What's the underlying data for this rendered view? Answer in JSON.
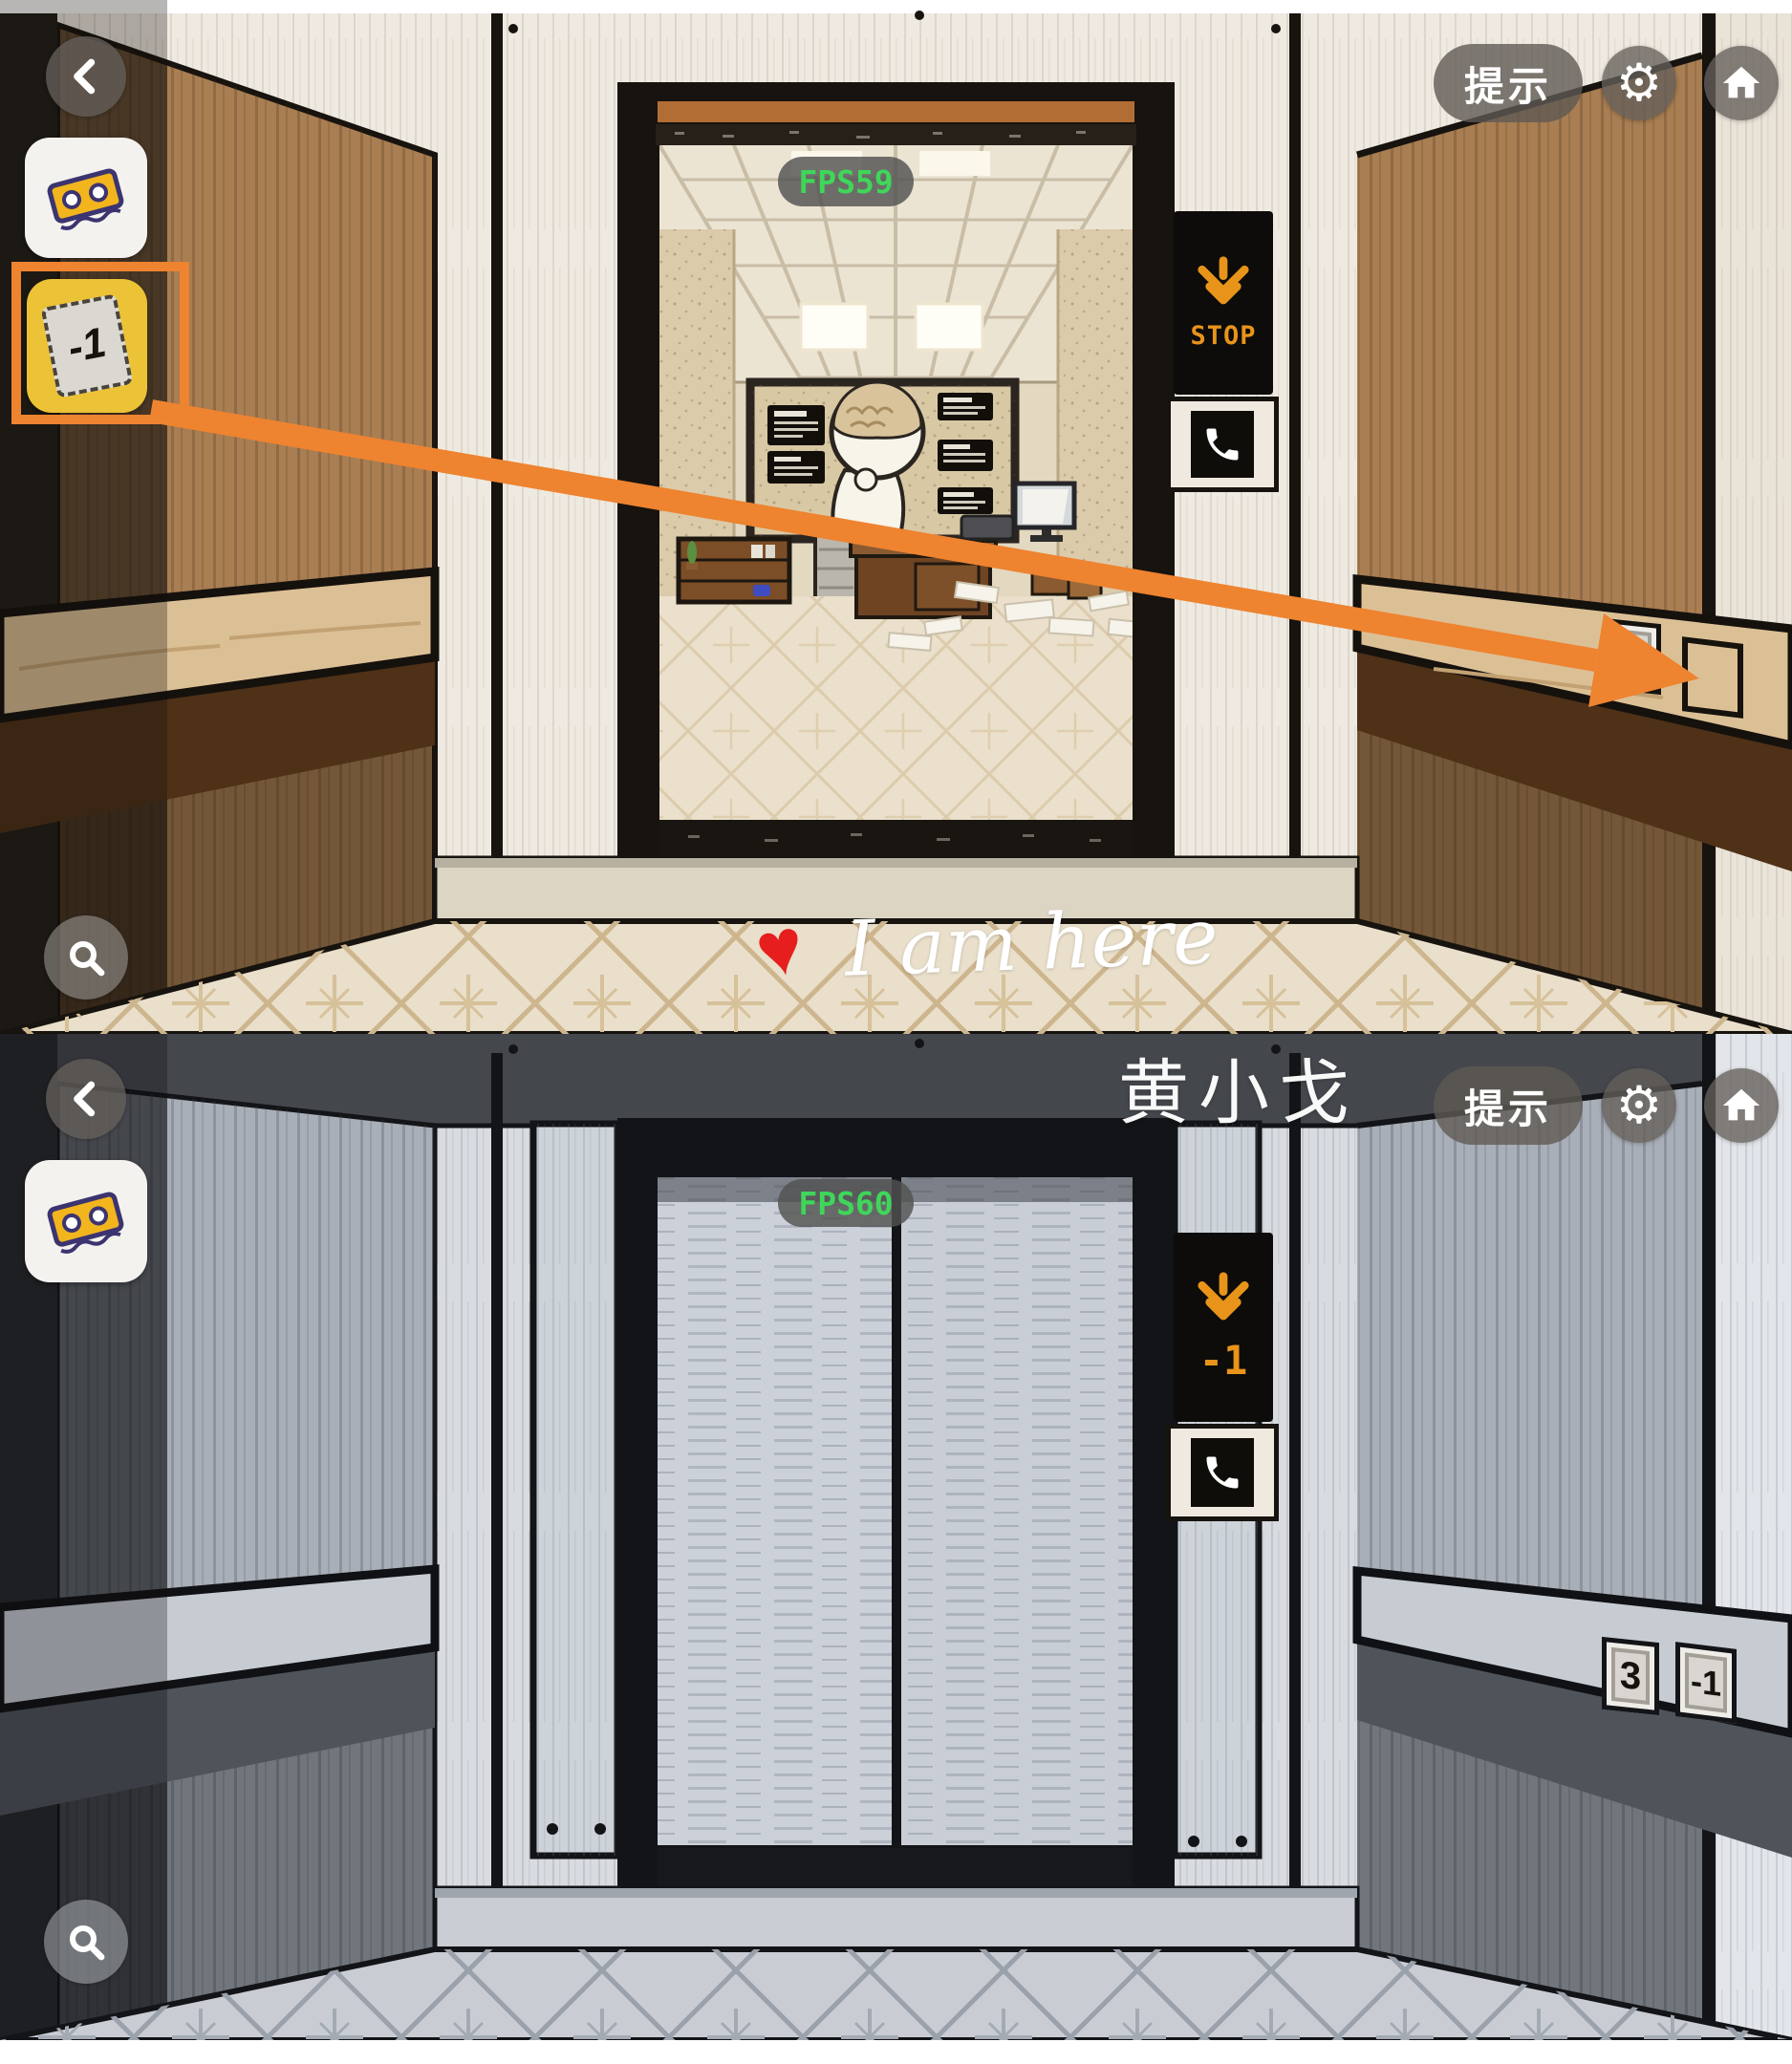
{
  "ui": {
    "hint_label": "提示",
    "colors": {
      "accent_orange": "#ee8330",
      "display_orange": "#e8941a",
      "fps_green": "#3fd65a",
      "selected_item_yellow": "#ecc236"
    },
    "icons": {
      "back": "chevron-left",
      "settings": "gear",
      "home": "home",
      "zoom": "magnifier",
      "phone": "phone-handset",
      "display_arrow": "down-arrow",
      "inventory_item_1": "cassette-ticket",
      "inventory_item_2": "minus1-tile"
    },
    "panels": [
      {
        "name": "elevator-open-doors",
        "fps": "FPS59",
        "display": {
          "direction": "down",
          "text": "STOP"
        },
        "floor_buttons": {
          "b3": "3",
          "empty_slot": ""
        },
        "inventory": {
          "minus1_label": "-1"
        },
        "watermark": {
          "heart": "♥",
          "text": "I am here"
        }
      },
      {
        "name": "elevator-closed-doors",
        "fps": "FPS60",
        "display": {
          "direction": "down",
          "text": "-1"
        },
        "floor_buttons": {
          "b3": "3",
          "bm1": "-1"
        },
        "watermark": {
          "text": "黄小戈"
        }
      }
    ]
  }
}
